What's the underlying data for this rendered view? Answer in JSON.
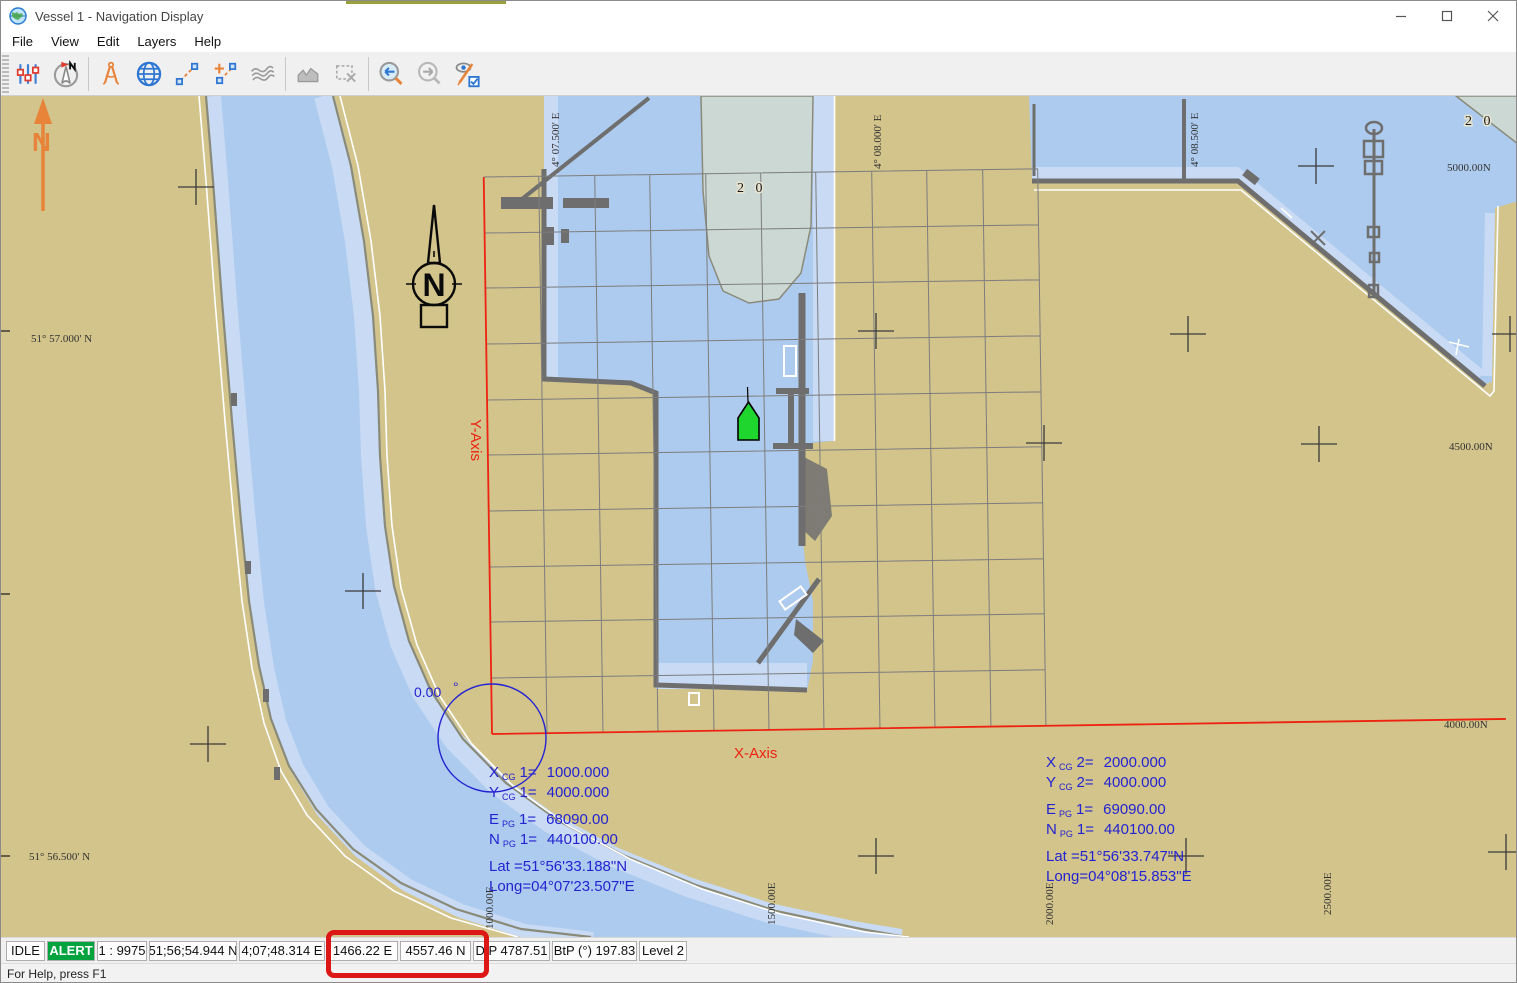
{
  "window": {
    "title": "Vessel 1 - Navigation Display",
    "app_icon": "globe-icon",
    "controls": {
      "minimize": "minimize-icon",
      "maximize": "maximize-icon",
      "close": "close-icon"
    }
  },
  "menu": {
    "items": [
      "File",
      "View",
      "Edit",
      "Layers",
      "Help"
    ]
  },
  "toolbar": {
    "buttons": [
      {
        "name": "display-settings-icon"
      },
      {
        "name": "north-compass-icon"
      },
      {
        "name": "dividers-measure-icon"
      },
      {
        "name": "globe-projection-icon"
      },
      {
        "name": "measure-line-icon"
      },
      {
        "name": "add-waypoint-icon"
      },
      {
        "name": "currents-layer-icon"
      },
      {
        "name": "depth-profile-icon",
        "disabled": true
      },
      {
        "name": "select-region-icon",
        "disabled": true
      },
      {
        "name": "zoom-previous-icon"
      },
      {
        "name": "zoom-next-icon",
        "disabled": true
      },
      {
        "name": "view-options-icon"
      }
    ]
  },
  "chart": {
    "colors": {
      "land": "#d2c48b",
      "water": "#adcbee",
      "shallow": "#c8daf4",
      "dredge": "#ccd8d4",
      "quay": "#6e6e6e",
      "grid": "#7d7d7d",
      "axis_red": "#ee2211",
      "annot_blue": "#2323d2",
      "orange": "#e8833a",
      "alert_green": "#00a33e",
      "highlight_red": "#dd1616"
    },
    "labels": {
      "lat_top": "51° 57.000' N",
      "lat_bottom": "51° 56.500' N",
      "lon_1": "4° 07.500' E",
      "lon_2": "4° 08.000' E",
      "lon_3": "4° 08.500' E",
      "grid_n_1": "5000.00N",
      "grid_n_2": "4500.00N",
      "grid_n_3": "4000.00N",
      "grid_e_1": "1000.00E",
      "grid_e_2": "1500.00E",
      "grid_e_3": "2000.00E",
      "grid_e_4": "2500.00E",
      "depth_mid": "2 0",
      "depth_ne": "2 0",
      "x_axis": "X-Axis",
      "y_axis": "Y-Axis",
      "heading": "0.00",
      "heading_unit": "°",
      "compass_n": "N",
      "north_arrow_n": "N"
    },
    "annotations": {
      "left": {
        "lines": [
          {
            "m": "X",
            "s": "CG",
            "i": "1=",
            "v": "1000.000"
          },
          {
            "m": "Y",
            "s": "CG",
            "i": "1=",
            "v": "4000.000"
          },
          {
            "m": "E",
            "s": "PG",
            "i": "1=",
            "v": "68090.00"
          },
          {
            "m": "N",
            "s": "PG",
            "i": "1=",
            "v": "440100.00"
          },
          {
            "m": "Lat =",
            "s": "",
            "i": "",
            "v": "51°56'33.188\"N"
          },
          {
            "m": "Long=",
            "s": "",
            "i": "",
            "v": "04°07'23.507\"E"
          }
        ]
      },
      "right": {
        "lines": [
          {
            "m": "X",
            "s": "CG",
            "i": "2=",
            "v": "2000.000"
          },
          {
            "m": "Y",
            "s": "CG",
            "i": "2=",
            "v": "4000.000"
          },
          {
            "m": "E",
            "s": "PG",
            "i": "1=",
            "v": "69090.00"
          },
          {
            "m": "N",
            "s": "PG",
            "i": "1=",
            "v": "440100.00"
          },
          {
            "m": "Lat =",
            "s": "",
            "i": "",
            "v": "51°56'33.747\"N"
          },
          {
            "m": "Long=",
            "s": "",
            "i": "",
            "v": "04°08'15.853\"E"
          }
        ]
      }
    }
  },
  "statusbar": {
    "cells": [
      "IDLE",
      "ALERT",
      "1 : 9975",
      "51;56;54.944 N",
      "4;07;48.314 E",
      "1466.22 E",
      "4557.46 N",
      "DtP 4787.51",
      "BtP (°) 197.83",
      "Level 2"
    ]
  },
  "helpbar": {
    "text": "For Help, press F1"
  }
}
